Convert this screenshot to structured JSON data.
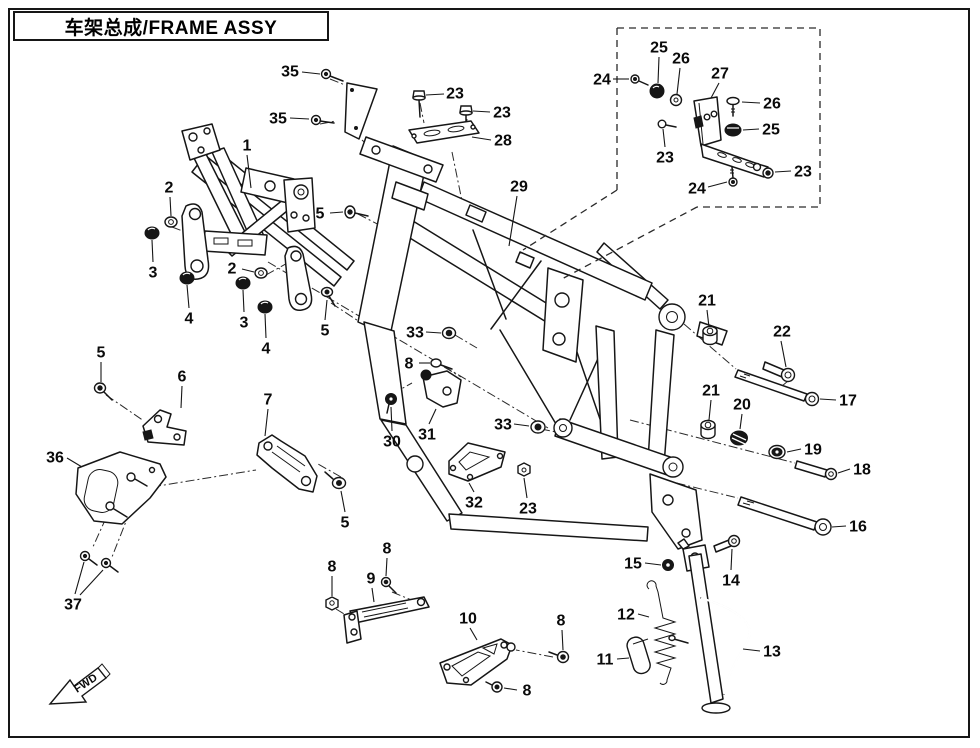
{
  "title": "车架总成/FRAME ASSY",
  "fwd": {
    "label": "FWD"
  },
  "colors": {
    "line": "#161616",
    "background": "#ffffff"
  },
  "callouts": [
    {
      "label": "1",
      "x": 247,
      "y": 145,
      "leaders": [
        [
          247,
          155,
          251,
          188
        ]
      ]
    },
    {
      "label": "2",
      "x": 169,
      "y": 187,
      "leaders": [
        [
          170,
          197,
          171,
          216
        ]
      ]
    },
    {
      "label": "3",
      "x": 153,
      "y": 272,
      "leaders": [
        [
          153,
          262,
          152,
          240
        ]
      ]
    },
    {
      "label": "4",
      "x": 189,
      "y": 318,
      "leaders": [
        [
          189,
          308,
          187,
          285
        ]
      ]
    },
    {
      "label": "2",
      "x": 232,
      "y": 268,
      "leaders": [
        [
          242,
          269,
          254,
          272
        ]
      ]
    },
    {
      "label": "3",
      "x": 244,
      "y": 322,
      "leaders": [
        [
          244,
          312,
          243,
          290
        ]
      ]
    },
    {
      "label": "4",
      "x": 266,
      "y": 348,
      "leaders": [
        [
          266,
          338,
          265,
          314
        ]
      ]
    },
    {
      "label": "5",
      "x": 320,
      "y": 213,
      "leaders": [
        [
          330,
          213,
          343,
          212
        ]
      ]
    },
    {
      "label": "5",
      "x": 325,
      "y": 330,
      "leaders": [
        [
          325,
          320,
          327,
          300
        ]
      ]
    },
    {
      "label": "35",
      "x": 290,
      "y": 71,
      "leaders": [
        [
          302,
          72,
          320,
          74
        ]
      ]
    },
    {
      "label": "35",
      "x": 278,
      "y": 118,
      "leaders": [
        [
          290,
          118,
          309,
          119
        ]
      ]
    },
    {
      "label": "23",
      "x": 455,
      "y": 93,
      "leaders": [
        [
          444,
          94,
          426,
          95
        ]
      ]
    },
    {
      "label": "23",
      "x": 502,
      "y": 112,
      "leaders": [
        [
          490,
          112,
          473,
          111
        ]
      ]
    },
    {
      "label": "28",
      "x": 503,
      "y": 140,
      "leaders": [
        [
          491,
          140,
          472,
          137
        ]
      ]
    },
    {
      "label": "29",
      "x": 519,
      "y": 186,
      "leaders": [
        [
          517,
          196,
          509,
          246
        ]
      ]
    },
    {
      "label": "24",
      "x": 602,
      "y": 79,
      "leaders": [
        [
          613,
          79,
          629,
          79
        ]
      ]
    },
    {
      "label": "25",
      "x": 659,
      "y": 47,
      "leaders": [
        [
          659,
          57,
          658,
          83
        ]
      ]
    },
    {
      "label": "26",
      "x": 681,
      "y": 58,
      "leaders": [
        [
          680,
          68,
          677,
          94
        ]
      ]
    },
    {
      "label": "27",
      "x": 720,
      "y": 73,
      "leaders": [
        [
          719,
          83,
          711,
          98
        ]
      ]
    },
    {
      "label": "26",
      "x": 772,
      "y": 103,
      "leaders": [
        [
          760,
          103,
          742,
          102
        ]
      ]
    },
    {
      "label": "25",
      "x": 771,
      "y": 129,
      "leaders": [
        [
          759,
          129,
          743,
          130
        ]
      ]
    },
    {
      "label": "23",
      "x": 665,
      "y": 157,
      "leaders": [
        [
          665,
          147,
          663,
          129
        ]
      ]
    },
    {
      "label": "23",
      "x": 803,
      "y": 171,
      "leaders": [
        [
          791,
          171,
          775,
          172
        ]
      ]
    },
    {
      "label": "24",
      "x": 697,
      "y": 188,
      "leaders": [
        [
          708,
          187,
          727,
          182
        ]
      ]
    },
    {
      "label": "33",
      "x": 415,
      "y": 332,
      "leaders": [
        [
          426,
          332,
          441,
          333
        ]
      ]
    },
    {
      "label": "8",
      "x": 409,
      "y": 363,
      "leaders": [
        [
          419,
          363,
          430,
          363
        ]
      ]
    },
    {
      "label": "30",
      "x": 392,
      "y": 441,
      "leaders": [
        [
          392,
          431,
          391,
          407
        ]
      ]
    },
    {
      "label": "31",
      "x": 427,
      "y": 434,
      "leaders": [
        [
          429,
          424,
          436,
          409
        ]
      ]
    },
    {
      "label": "33",
      "x": 503,
      "y": 424,
      "leaders": [
        [
          514,
          424,
          529,
          426
        ]
      ]
    },
    {
      "label": "32",
      "x": 474,
      "y": 502,
      "leaders": [
        [
          474,
          492,
          469,
          483
        ]
      ]
    },
    {
      "label": "23",
      "x": 528,
      "y": 508,
      "leaders": [
        [
          527,
          498,
          524,
          478
        ]
      ]
    },
    {
      "label": "5",
      "x": 101,
      "y": 352,
      "leaders": [
        [
          101,
          362,
          101,
          382
        ]
      ]
    },
    {
      "label": "6",
      "x": 182,
      "y": 376,
      "leaders": [
        [
          182,
          386,
          181,
          408
        ]
      ]
    },
    {
      "label": "36",
      "x": 55,
      "y": 457,
      "leaders": [
        [
          67,
          458,
          82,
          467
        ]
      ]
    },
    {
      "label": "37",
      "x": 73,
      "y": 604,
      "leaders": [
        [
          75,
          594,
          84,
          562
        ],
        [
          80,
          595,
          103,
          570
        ]
      ]
    },
    {
      "label": "7",
      "x": 268,
      "y": 399,
      "leaders": [
        [
          268,
          409,
          265,
          436
        ]
      ]
    },
    {
      "label": "5",
      "x": 345,
      "y": 522,
      "leaders": [
        [
          345,
          512,
          341,
          491
        ]
      ]
    },
    {
      "label": "8",
      "x": 332,
      "y": 566,
      "leaders": [
        [
          332,
          576,
          332,
          596
        ]
      ]
    },
    {
      "label": "9",
      "x": 371,
      "y": 578,
      "leaders": [
        [
          372,
          588,
          374,
          602
        ]
      ]
    },
    {
      "label": "8",
      "x": 387,
      "y": 548,
      "leaders": [
        [
          387,
          558,
          386,
          576
        ]
      ]
    },
    {
      "label": "10",
      "x": 468,
      "y": 618,
      "leaders": [
        [
          470,
          628,
          477,
          640
        ]
      ]
    },
    {
      "label": "8",
      "x": 561,
      "y": 620,
      "leaders": [
        [
          562,
          630,
          563,
          650
        ]
      ]
    },
    {
      "label": "8",
      "x": 527,
      "y": 690,
      "leaders": [
        [
          517,
          690,
          504,
          688
        ]
      ]
    },
    {
      "label": "21",
      "x": 707,
      "y": 300,
      "leaders": [
        [
          707,
          310,
          709,
          327
        ]
      ]
    },
    {
      "label": "22",
      "x": 782,
      "y": 331,
      "leaders": [
        [
          781,
          341,
          786,
          367
        ]
      ]
    },
    {
      "label": "17",
      "x": 848,
      "y": 400,
      "leaders": [
        [
          836,
          400,
          820,
          399
        ]
      ]
    },
    {
      "label": "21",
      "x": 711,
      "y": 390,
      "leaders": [
        [
          711,
          400,
          709,
          420
        ]
      ]
    },
    {
      "label": "20",
      "x": 742,
      "y": 404,
      "leaders": [
        [
          742,
          414,
          740,
          429
        ]
      ]
    },
    {
      "label": "19",
      "x": 813,
      "y": 449,
      "leaders": [
        [
          801,
          449,
          787,
          452
        ]
      ]
    },
    {
      "label": "18",
      "x": 862,
      "y": 469,
      "leaders": [
        [
          850,
          469,
          838,
          473
        ]
      ]
    },
    {
      "label": "16",
      "x": 858,
      "y": 526,
      "leaders": [
        [
          846,
          526,
          832,
          527
        ]
      ]
    },
    {
      "label": "15",
      "x": 633,
      "y": 563,
      "leaders": [
        [
          645,
          563,
          661,
          565
        ]
      ]
    },
    {
      "label": "14",
      "x": 731,
      "y": 580,
      "leaders": [
        [
          731,
          570,
          732,
          549
        ]
      ]
    },
    {
      "label": "12",
      "x": 626,
      "y": 614,
      "leaders": [
        [
          638,
          614,
          649,
          617
        ]
      ]
    },
    {
      "label": "11",
      "x": 605,
      "y": 659,
      "leaders": [
        [
          617,
          659,
          629,
          658
        ]
      ]
    },
    {
      "label": "13",
      "x": 772,
      "y": 651,
      "leaders": [
        [
          760,
          651,
          743,
          649
        ]
      ]
    }
  ]
}
